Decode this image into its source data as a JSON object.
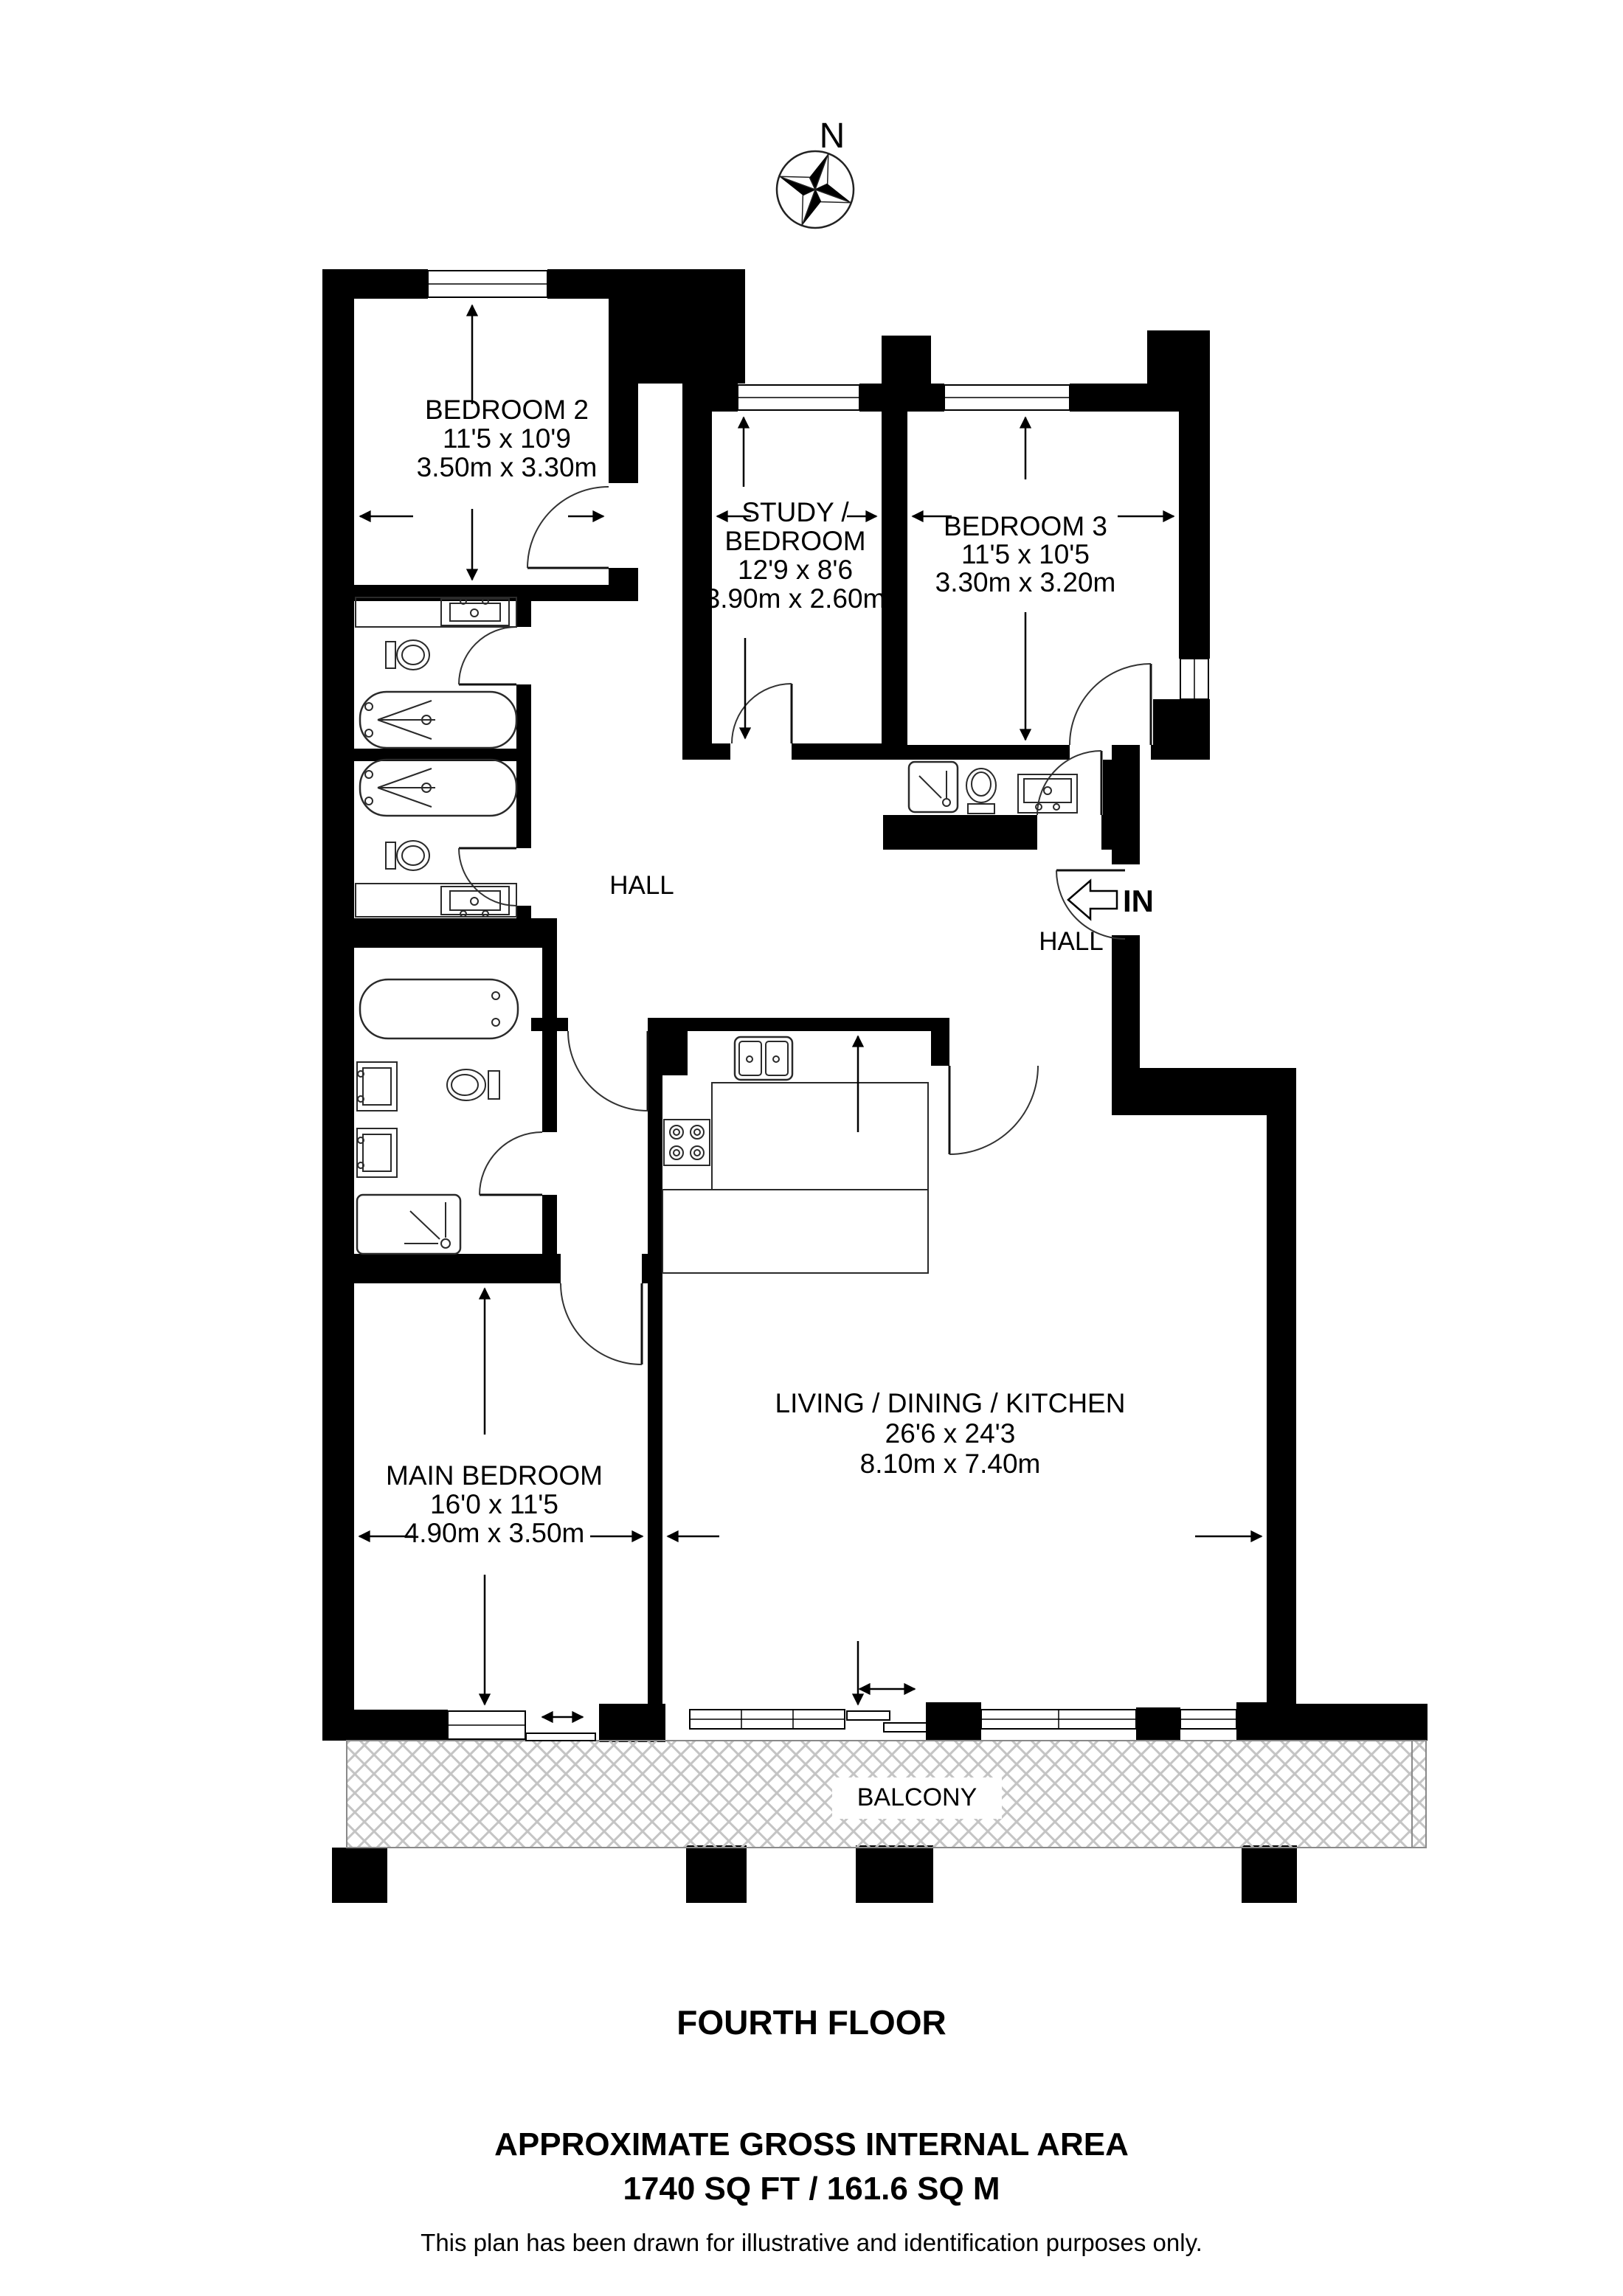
{
  "compass": {
    "north_label": "N"
  },
  "entry": {
    "label": "IN"
  },
  "rooms": {
    "bedroom2": {
      "name": "BEDROOM 2",
      "imperial": "11'5 x 10'9",
      "metric": "3.50m x 3.30m"
    },
    "study": {
      "name_line1": "STUDY /",
      "name_line2": "BEDROOM",
      "imperial": "12'9 x 8'6",
      "metric": "3.90m x 2.60m"
    },
    "bedroom3": {
      "name": "BEDROOM 3",
      "imperial": "11'5 x 10'5",
      "metric": "3.30m x 3.20m"
    },
    "hall_west": {
      "name": "HALL"
    },
    "hall_east": {
      "name": "HALL"
    },
    "living": {
      "name": "LIVING / DINING / KITCHEN",
      "imperial": "26'6 x 24'3",
      "metric": "8.10m x 7.40m"
    },
    "main_bedroom": {
      "name": "MAIN BEDROOM",
      "imperial": "16'0 x 11'5",
      "metric": "4.90m x 3.50m"
    },
    "balcony": {
      "name": "BALCONY"
    }
  },
  "footer": {
    "floor": "FOURTH FLOOR",
    "area_title": "APPROXIMATE GROSS INTERNAL AREA",
    "area_value": "1740 SQ FT / 161.6 SQ M",
    "disclaimer": "This plan has been drawn for illustrative and identification purposes only."
  },
  "colors": {
    "wall": "#000000",
    "hatch": "#c4c4c4",
    "background": "#ffffff"
  }
}
